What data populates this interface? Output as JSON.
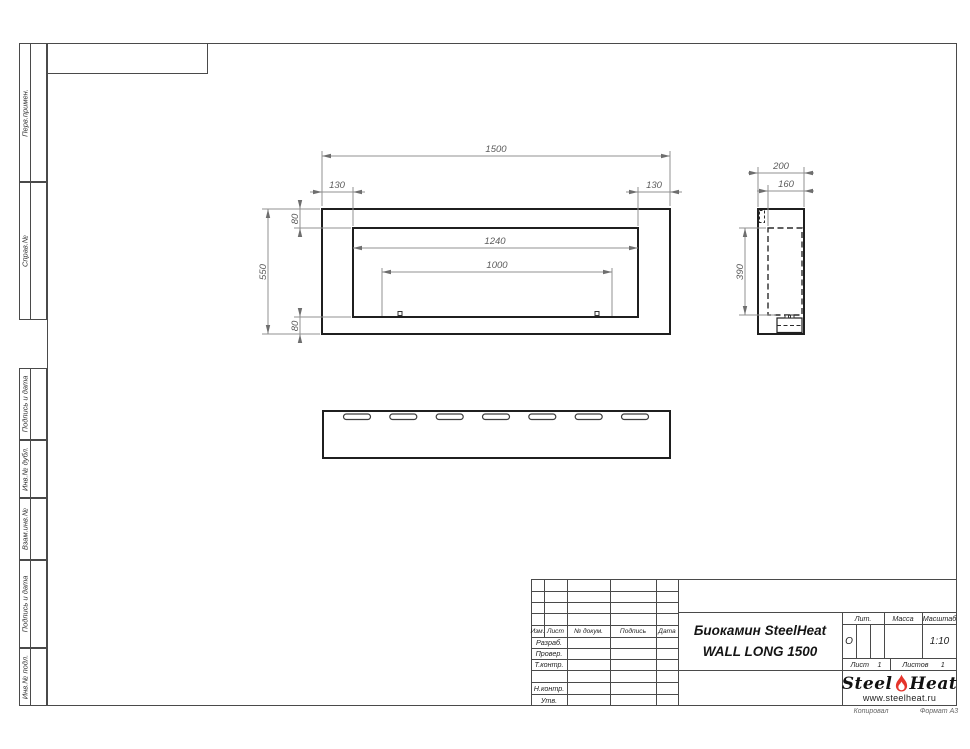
{
  "drawing": {
    "front_view": {
      "dims": {
        "overall_width": "1500",
        "offset_left": "130",
        "offset_right": "130",
        "flange_top": "80",
        "overall_height": "550",
        "opening_width": "1240",
        "burner_length": "1000",
        "flange_bottom": "80"
      }
    },
    "side_view": {
      "dims": {
        "overall_depth": "200",
        "body_depth": "160",
        "body_height": "390"
      }
    }
  },
  "sidebar": {
    "items": [
      {
        "label": "Перв.примен."
      },
      {
        "label": "Справ.№"
      },
      {
        "label": "Подпись и дата"
      },
      {
        "label": "Инв.№ дубл."
      },
      {
        "label": "Взам.инв.№"
      },
      {
        "label": "Подпись и дата"
      },
      {
        "label": "Инв.№ подл."
      }
    ]
  },
  "title_block": {
    "header_cols": {
      "izm": "Изм.",
      "list": "Лист",
      "doc": "№ докум.",
      "sign": "Подпись",
      "date": "Дата"
    },
    "rows": {
      "razrab": "Разраб.",
      "prover": "Провер.",
      "tkontr": "Т.контр.",
      "nkontr": "Н.контр.",
      "utv": "Утв."
    },
    "name_line1": "Биокамин SteelHeat",
    "name_line2": "WALL LONG 1500",
    "lit_label": "Лит.",
    "lit_value": "О",
    "mass_label": "Масса",
    "scale_label": "Масштаб",
    "scale_value": "1:10",
    "sheet_label": "Лист",
    "sheet_value": "1",
    "sheets_label": "Листов",
    "sheets_value": "1",
    "logo": {
      "part1": "Steel",
      "part2": "Heat",
      "url": "www.steelheat.ru",
      "flame_color": "#e5342b"
    }
  },
  "footer": {
    "copied": "Копировал",
    "format": "Формат А3"
  }
}
